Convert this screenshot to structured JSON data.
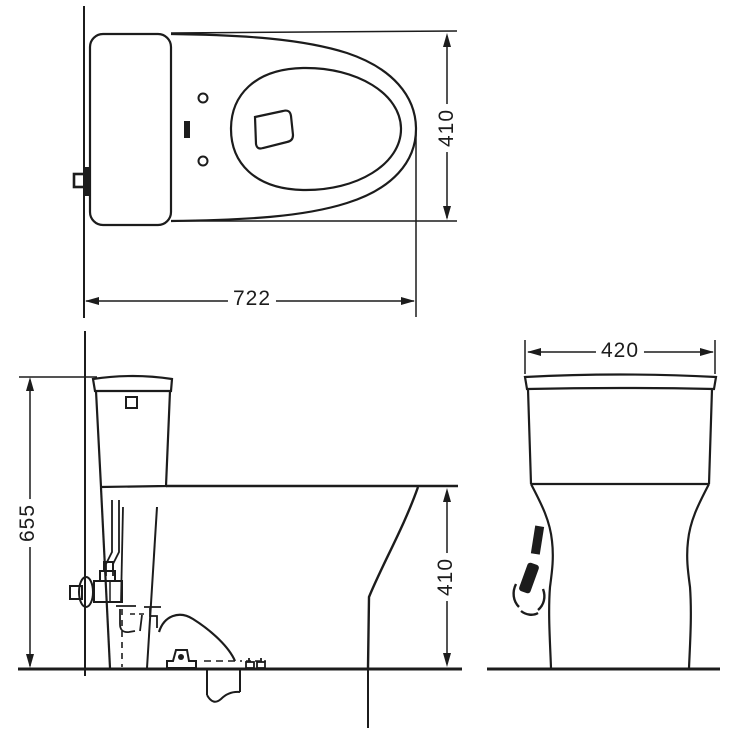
{
  "drawing": {
    "dimensions": {
      "top_view_width": "722",
      "top_view_depth": "410",
      "side_view_total_height": "655",
      "side_view_bowl_height": "410",
      "front_view_width": "420"
    },
    "colors": {
      "line": "#1c1c1c",
      "background": "#ffffff"
    }
  }
}
